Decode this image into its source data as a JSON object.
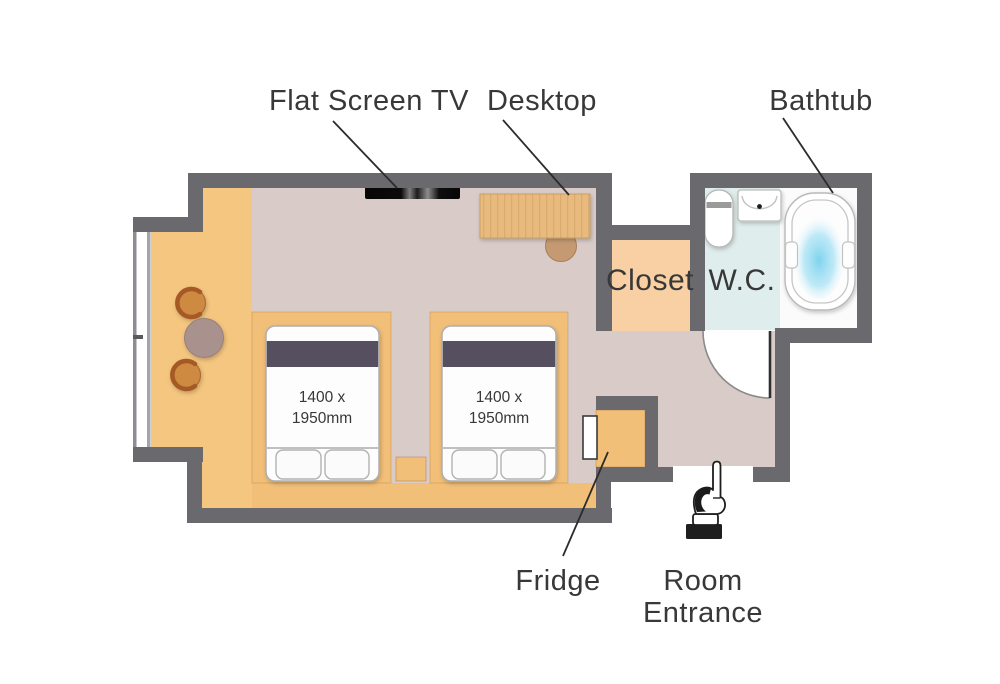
{
  "labels": {
    "flat_screen_tv": "Flat Screen TV",
    "desktop": "Desktop",
    "bathtub": "Bathtub",
    "closet": "Closet",
    "wc": "W.C.",
    "fridge": "Fridge",
    "room_entrance_line1": "Room",
    "room_entrance_line2": "Entrance"
  },
  "beds": [
    {
      "dimensions_line1": "1400 x",
      "dimensions_line2": "1950mm"
    },
    {
      "dimensions_line1": "1400 x",
      "dimensions_line2": "1950mm"
    }
  ],
  "icons": {
    "room_entrance": "pointing-hand-icon"
  },
  "colors": {
    "wall": "#6a696d",
    "wood_floor": "#f5c67f",
    "wood_furniture": "#f2bf79",
    "desk_wood": "#e8ba7d",
    "bedroom_floor": "#d9cbc8",
    "closet_floor": "#f9d0a4",
    "wc_floor": "#dfeeec",
    "bath_floor": "#fbfbfb",
    "bed_band": "#554f5e",
    "water": "#7ed3ee",
    "chair_wood": "#cf8a43",
    "chair_back": "#a55a28",
    "table_top": "#a9918d",
    "fixture_white": "#ffffff",
    "label_text": "#383838",
    "leader_line": "#2b2b2b"
  }
}
